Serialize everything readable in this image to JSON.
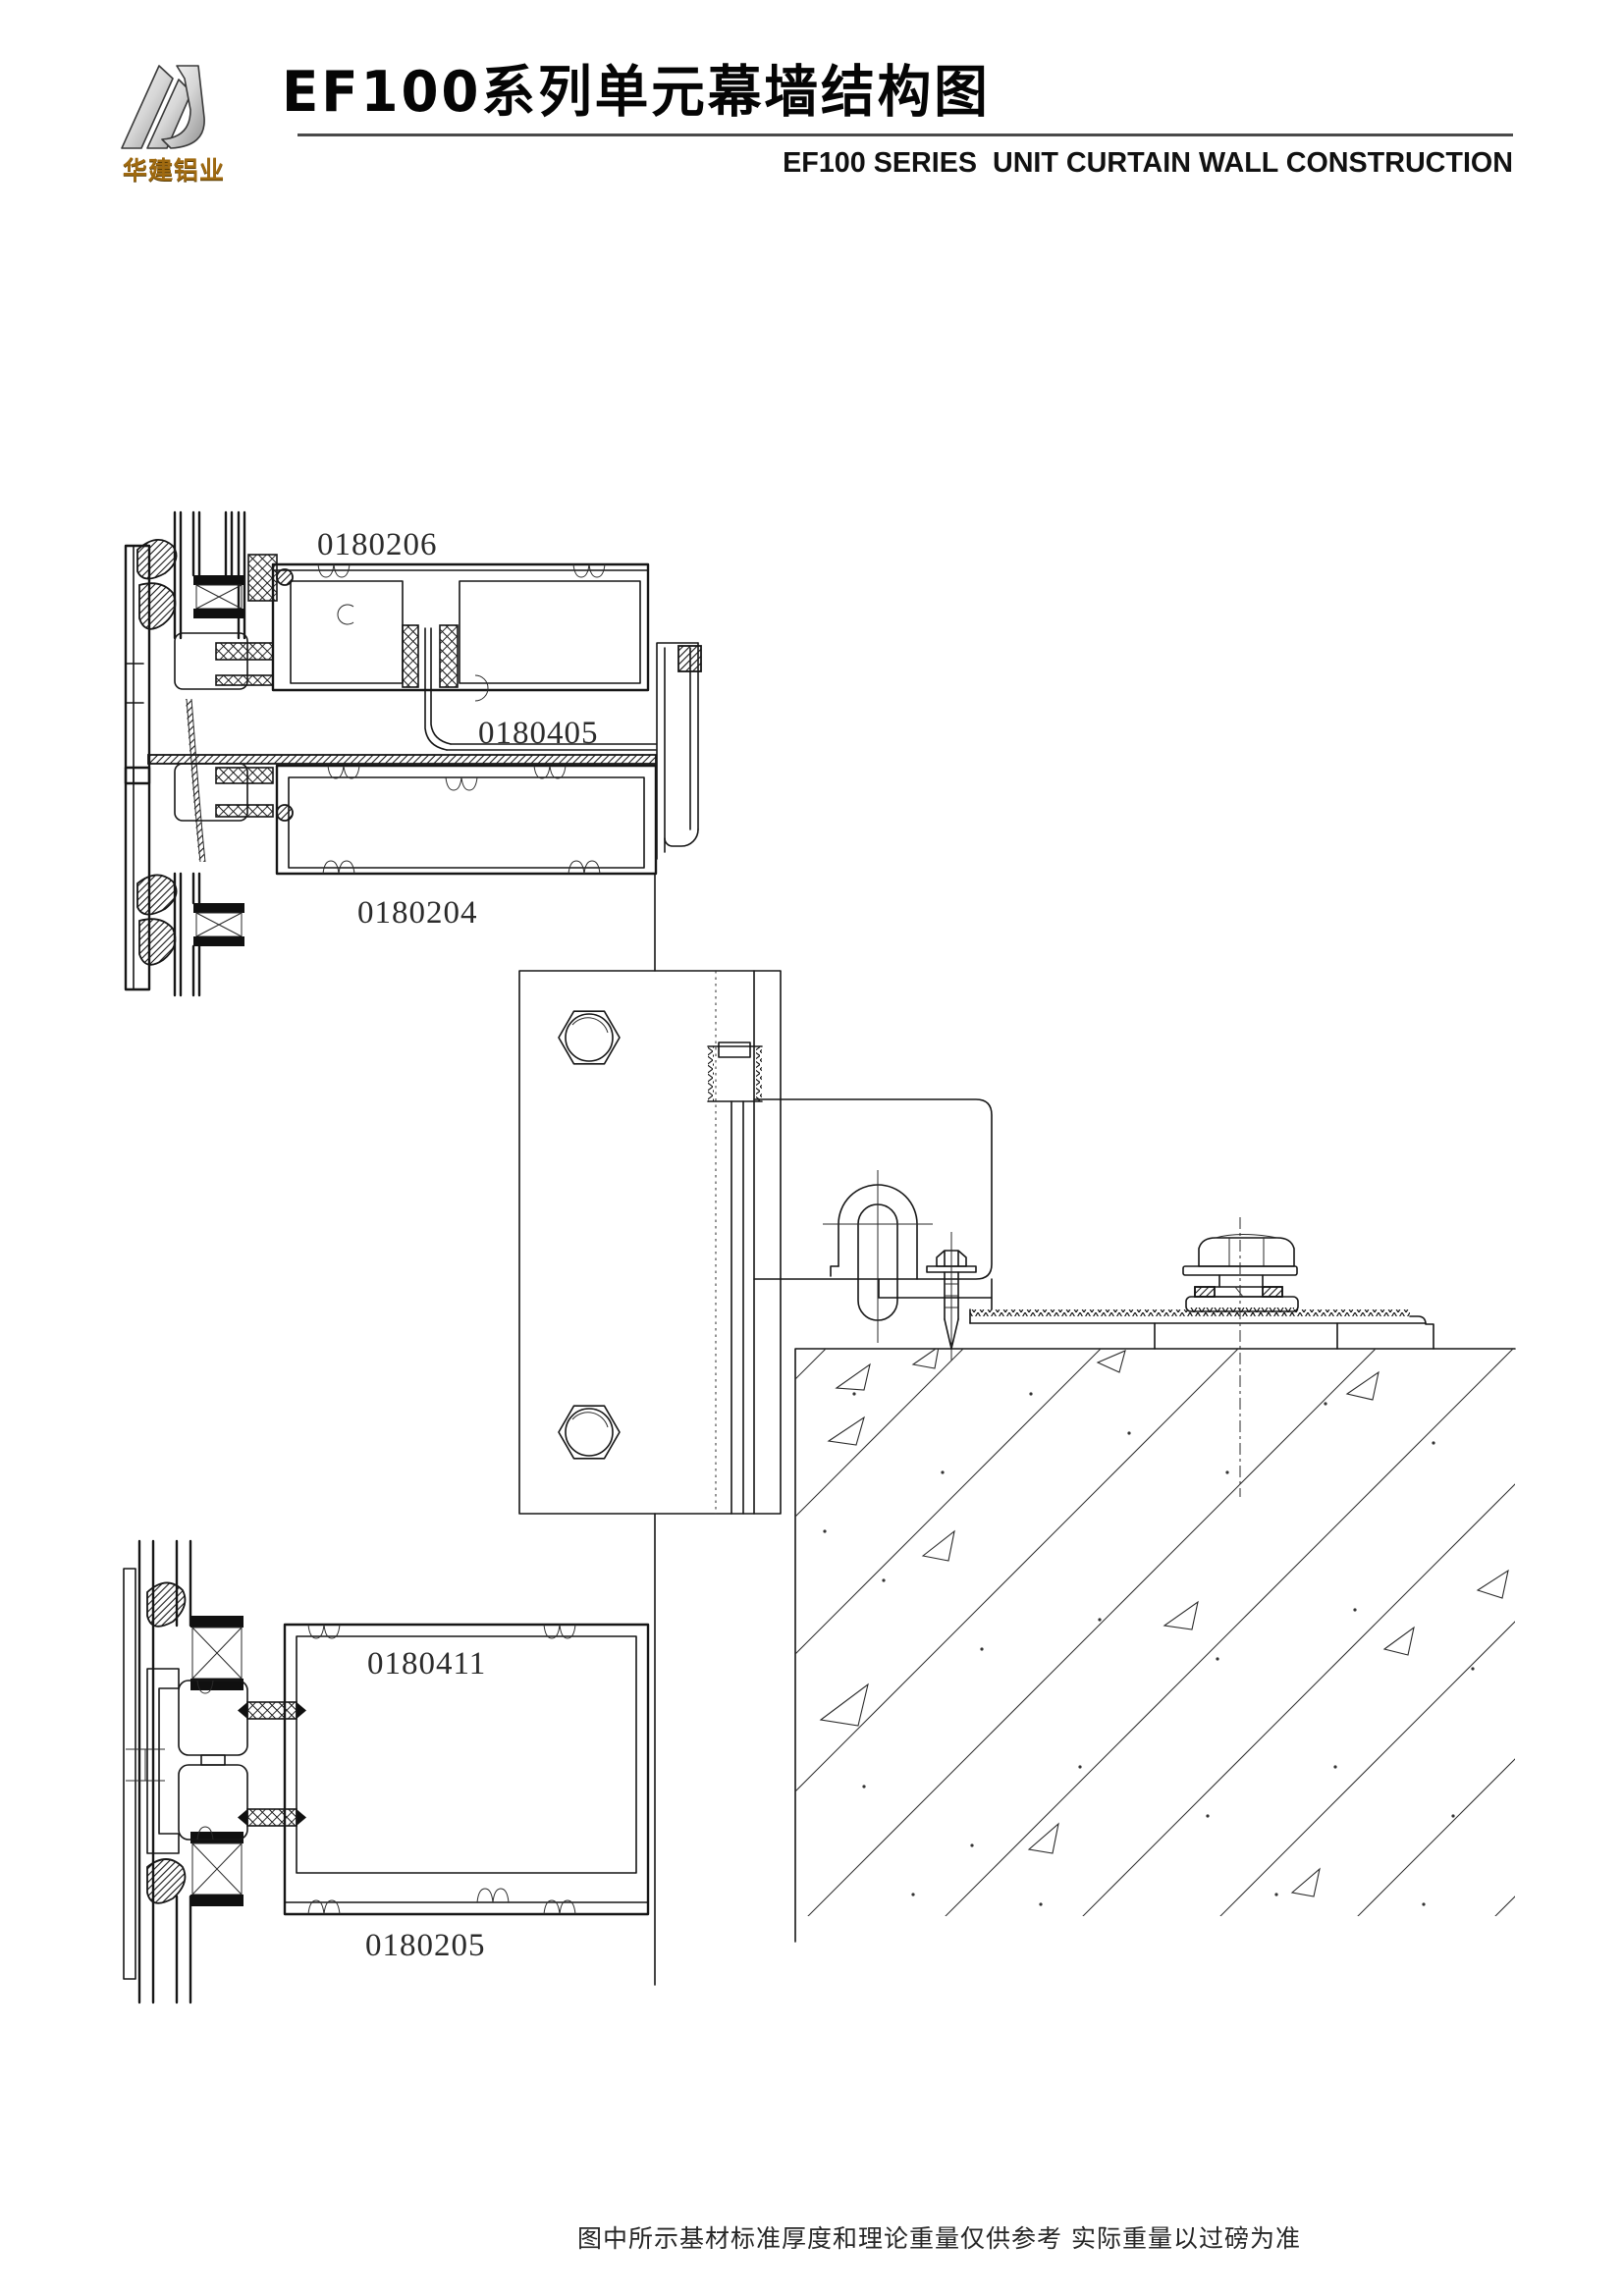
{
  "header": {
    "logo": {
      "monogram_icon": "hj-triangle-icon",
      "brand": "华建铝业"
    },
    "title": "EF100系列单元幕墙结构图",
    "subtitle": "EF100 SERIES  UNIT CURTAIN WALL CONSTRUCTION"
  },
  "drawing": {
    "description": "unit curtain wall stack joint, hanger bracket and embed anchor section",
    "part_labels": [
      {
        "text": "0180206"
      },
      {
        "text": "0180405"
      },
      {
        "text": "0180204"
      },
      {
        "text": "0180411"
      },
      {
        "text": "0180205"
      }
    ]
  },
  "footer": {
    "note": "图中所示基材标准厚度和理论重量仅供参考 实际重量以过磅为准"
  },
  "colors": {
    "line": "#161616",
    "label_text": "#2b2b2b",
    "title_text": "#050505",
    "brand_gold_light": "#e0b35a",
    "brand_gold_dark": "#8a5a00",
    "logo_silver_light": "#f8f8f8",
    "logo_silver_dark": "#8f8f8f",
    "background": "#ffffff"
  }
}
